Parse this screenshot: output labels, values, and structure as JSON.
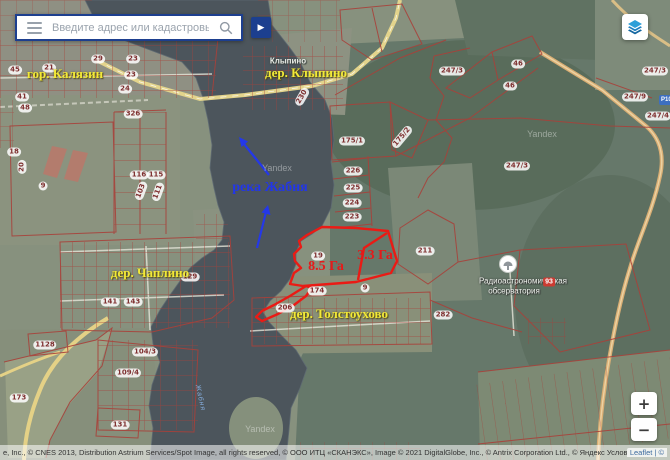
{
  "search_bar": {
    "placeholder": "Введите адрес или кадастровый номер"
  },
  "buttons": {
    "go": "▶",
    "zoom_in": "+",
    "zoom_out": "−"
  },
  "attribution": {
    "text": "е, Inc., © CNES 2013, Distribution Astrium Services/Spot Image, all rights reserved, © ООО ИТЦ «СКАНЭКС», Image © 2021 DigitalGlobe, Inc., © Antrix Corporation Ltd., © Яндекс Условия использован",
    "leaflet": "Leaflet | ©"
  },
  "colors": {
    "selection_red": "#ea1b15",
    "parcel_red": "#a9413a",
    "annotation_blue": "#2236e8",
    "village_yellow": "#f2e937",
    "ui_navy": "#1c3f8f"
  },
  "map": {
    "village_labels": [
      {
        "text": "гор. Калязин",
        "x": 65,
        "y": 74
      },
      {
        "text": "дер. Клыпино",
        "x": 306,
        "y": 73
      },
      {
        "text": "дер. Чаплино",
        "x": 150,
        "y": 273
      },
      {
        "text": "дер. Толстоухово",
        "x": 339,
        "y": 314
      }
    ],
    "annotation_labels": [
      {
        "text": "река Жабня",
        "x": 270,
        "y": 188,
        "cls": "lbl-blue"
      },
      {
        "text": "8.5 Га",
        "x": 326,
        "y": 267,
        "cls": "lbl-red"
      },
      {
        "text": "3.3 Га",
        "x": 375,
        "y": 256,
        "cls": "lbl-red"
      }
    ],
    "base_labels": [
      {
        "text": "Клыпино",
        "x": 288,
        "y": 61,
        "cls": "lbl-place"
      },
      {
        "text": "Радиоастрономическая",
        "x": 523,
        "y": 281,
        "cls": "lbl-poi"
      },
      {
        "text": "обсерватория",
        "x": 514,
        "y": 291,
        "cls": "lbl-poi"
      },
      {
        "text": "Жабня",
        "x": 200,
        "y": 398,
        "cls": "lbl-river",
        "rot": 78
      },
      {
        "text": "Yandex",
        "x": 277,
        "y": 168,
        "cls": "lbl-wm"
      },
      {
        "text": "Yandex",
        "x": 542,
        "y": 134,
        "cls": "lbl-wm"
      },
      {
        "text": "Yandex",
        "x": 260,
        "y": 429,
        "cls": "lbl-wm"
      }
    ],
    "parcel_labels": [
      {
        "text": "45",
        "x": 15,
        "y": 70
      },
      {
        "text": "21",
        "x": 49,
        "y": 68
      },
      {
        "text": "29",
        "x": 98,
        "y": 59
      },
      {
        "text": "23",
        "x": 133,
        "y": 59
      },
      {
        "text": "23",
        "x": 131,
        "y": 75
      },
      {
        "text": "24",
        "x": 125,
        "y": 89
      },
      {
        "text": "41",
        "x": 22,
        "y": 97
      },
      {
        "text": "48",
        "x": 25,
        "y": 108
      },
      {
        "text": "326",
        "x": 133,
        "y": 114
      },
      {
        "text": "18",
        "x": 14,
        "y": 152
      },
      {
        "text": "20",
        "x": 22,
        "y": 167,
        "rot": -90
      },
      {
        "text": "9",
        "x": 43,
        "y": 186
      },
      {
        "text": "116",
        "x": 139,
        "y": 175
      },
      {
        "text": "115",
        "x": 156,
        "y": 175
      },
      {
        "text": "103",
        "x": 141,
        "y": 191,
        "rot": -70
      },
      {
        "text": "111",
        "x": 158,
        "y": 192,
        "rot": -70
      },
      {
        "text": "230",
        "x": 302,
        "y": 97,
        "rot": -60
      },
      {
        "text": "175/1",
        "x": 352,
        "y": 141
      },
      {
        "text": "175/2",
        "x": 402,
        "y": 137,
        "rot": -50
      },
      {
        "text": "226",
        "x": 353,
        "y": 171
      },
      {
        "text": "225",
        "x": 353,
        "y": 188
      },
      {
        "text": "224",
        "x": 352,
        "y": 203
      },
      {
        "text": "223",
        "x": 352,
        "y": 217
      },
      {
        "text": "19",
        "x": 318,
        "y": 256
      },
      {
        "text": "174",
        "x": 317,
        "y": 291
      },
      {
        "text": "9",
        "x": 365,
        "y": 288
      },
      {
        "text": "206",
        "x": 285,
        "y": 308
      },
      {
        "text": "129",
        "x": 190,
        "y": 277
      },
      {
        "text": "141",
        "x": 110,
        "y": 302
      },
      {
        "text": "143",
        "x": 133,
        "y": 302
      },
      {
        "text": "1128",
        "x": 45,
        "y": 345
      },
      {
        "text": "104/3",
        "x": 145,
        "y": 352
      },
      {
        "text": "109/4",
        "x": 128,
        "y": 373
      },
      {
        "text": "173",
        "x": 19,
        "y": 398
      },
      {
        "text": "131",
        "x": 120,
        "y": 425
      },
      {
        "text": "211",
        "x": 425,
        "y": 251
      },
      {
        "text": "282",
        "x": 443,
        "y": 315
      },
      {
        "text": "247/3",
        "x": 452,
        "y": 71
      },
      {
        "text": "46",
        "x": 518,
        "y": 64
      },
      {
        "text": "46",
        "x": 510,
        "y": 86
      },
      {
        "text": "247/9",
        "x": 635,
        "y": 97
      },
      {
        "text": "247/3",
        "x": 517,
        "y": 166
      },
      {
        "text": "247/3",
        "x": 655,
        "y": 71
      },
      {
        "text": "247/4",
        "x": 658,
        "y": 116
      }
    ],
    "poi_badge": "93",
    "road_shield": "Р104"
  }
}
